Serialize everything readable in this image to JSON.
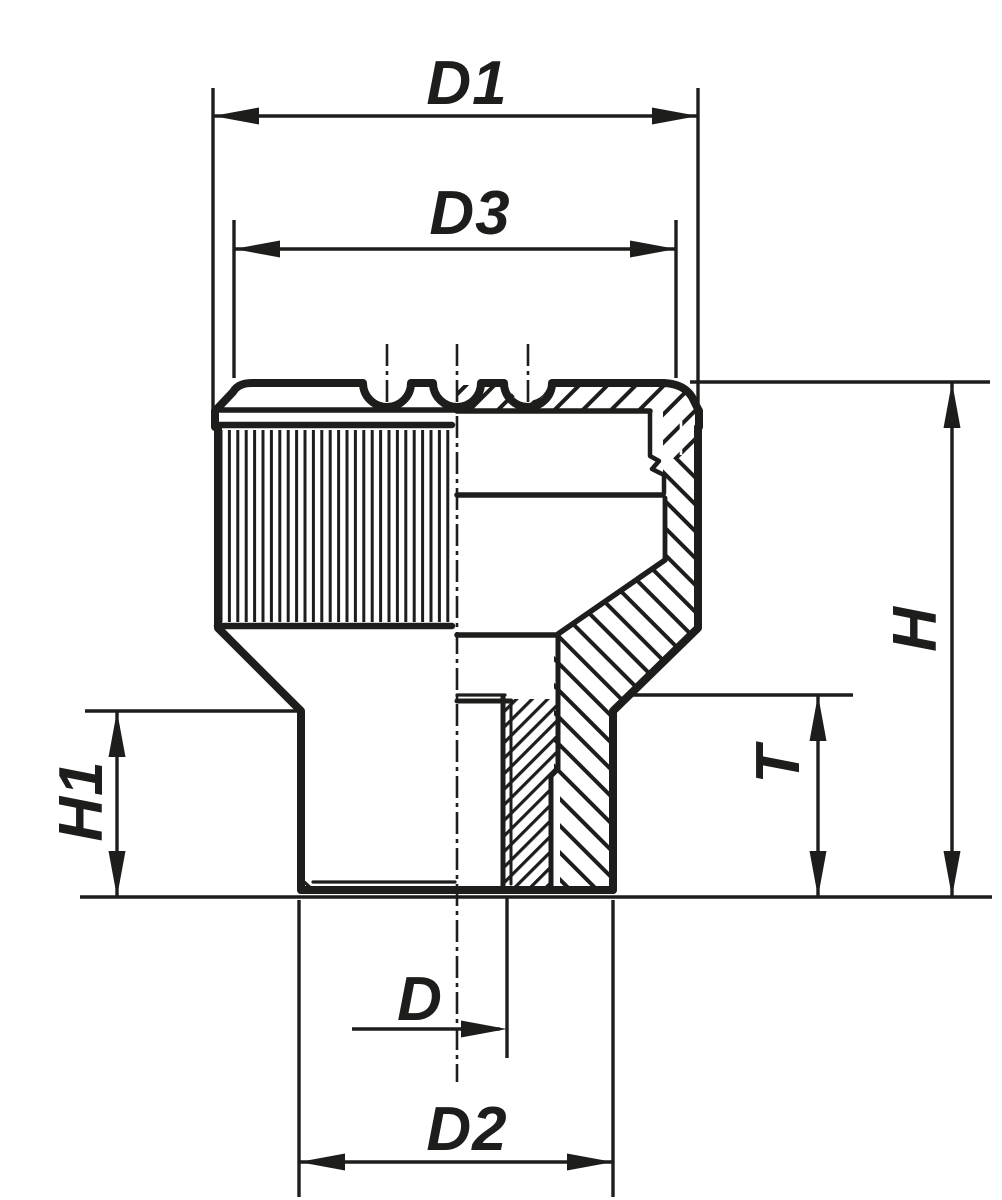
{
  "drawing": {
    "background_color": "#ffffff",
    "ink_color": "#1d1d1b",
    "dimension_labels": {
      "d1": "D1",
      "d3": "D3",
      "h": "H",
      "h1": "H1",
      "t": "T",
      "d": "D",
      "d2": "D2"
    }
  }
}
